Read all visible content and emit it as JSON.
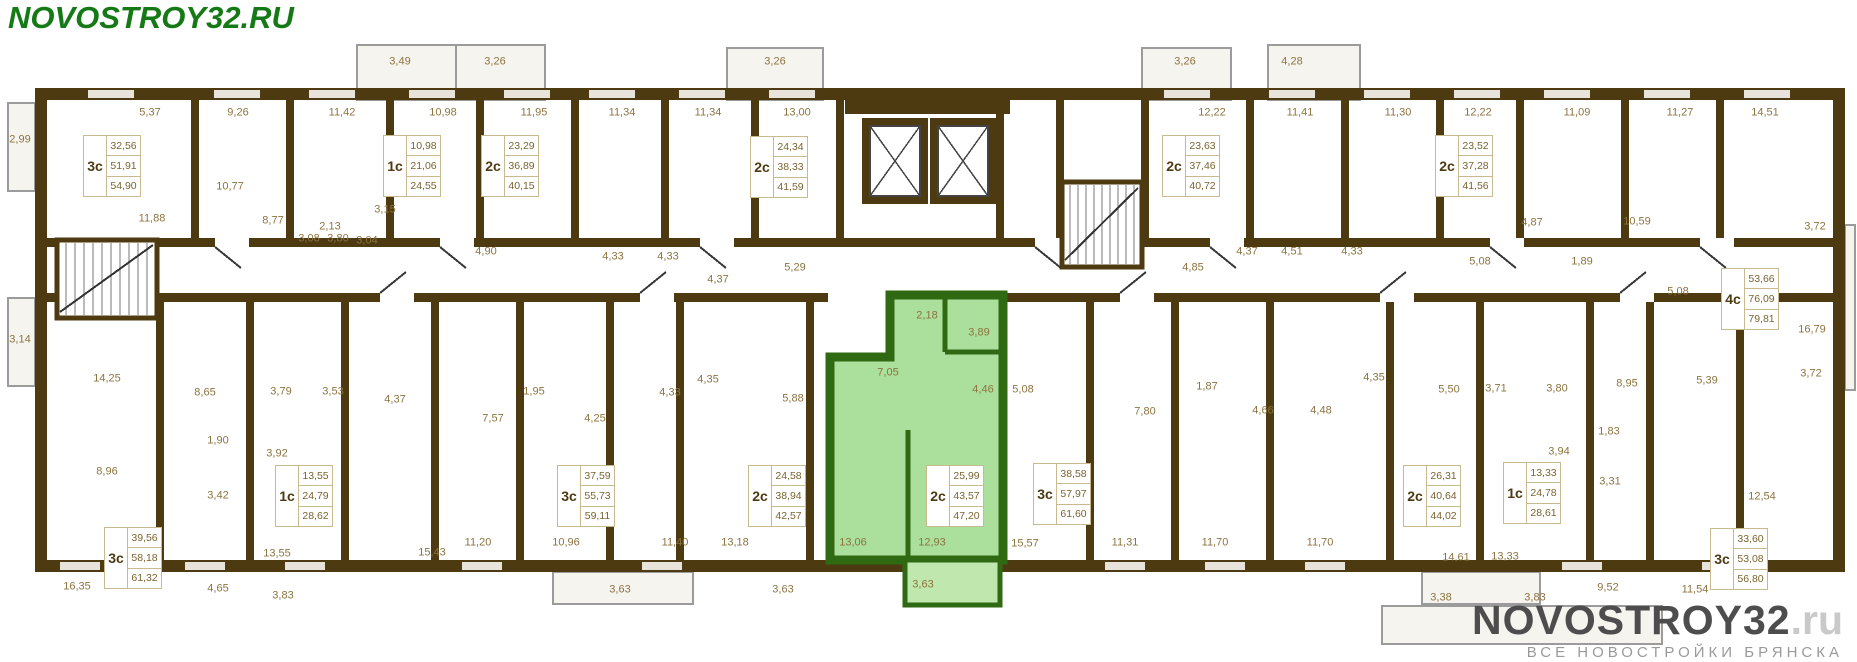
{
  "logo": {
    "text": "NOVOSTROY32.RU"
  },
  "watermark": {
    "brand": "NOVOSTROY32",
    "tld": ".ru",
    "tagline": "ВСЕ НОВОСТРОЙКИ БРЯНСКА"
  },
  "plan": {
    "colors": {
      "wall": "#4e3a11",
      "highlight_fill": "#abdf9c",
      "highlight_wall": "#2f6a12",
      "dimension_text": "#8c7440",
      "logo_green": "#157a15"
    },
    "apartments": [
      {
        "type": "3с",
        "areas": [
          "32,56",
          "51,91",
          "54,90"
        ],
        "x": 83,
        "y": 135,
        "highlighted": false
      },
      {
        "type": "1с",
        "areas": [
          "10,98",
          "21,06",
          "24,55"
        ],
        "x": 383,
        "y": 135,
        "highlighted": false
      },
      {
        "type": "2с",
        "areas": [
          "23,29",
          "36,89",
          "40,15"
        ],
        "x": 481,
        "y": 135,
        "highlighted": false
      },
      {
        "type": "2с",
        "areas": [
          "24,34",
          "38,33",
          "41,59"
        ],
        "x": 750,
        "y": 136,
        "highlighted": false
      },
      {
        "type": "2с",
        "areas": [
          "23,63",
          "37,46",
          "40,72"
        ],
        "x": 1162,
        "y": 135,
        "highlighted": false
      },
      {
        "type": "2с",
        "areas": [
          "23,52",
          "37,28",
          "41,56"
        ],
        "x": 1435,
        "y": 135,
        "highlighted": false
      },
      {
        "type": "4с",
        "areas": [
          "53,66",
          "76,09",
          "79,81"
        ],
        "x": 1721,
        "y": 268,
        "highlighted": false
      },
      {
        "type": "3с",
        "areas": [
          "39,56",
          "58,18",
          "61,32"
        ],
        "x": 104,
        "y": 527,
        "highlighted": false
      },
      {
        "type": "1с",
        "areas": [
          "13,55",
          "24,79",
          "28,62"
        ],
        "x": 275,
        "y": 465,
        "highlighted": false
      },
      {
        "type": "3с",
        "areas": [
          "37,59",
          "55,73",
          "59,11"
        ],
        "x": 557,
        "y": 465,
        "highlighted": false
      },
      {
        "type": "2с",
        "areas": [
          "24,58",
          "38,94",
          "42,57"
        ],
        "x": 748,
        "y": 465,
        "highlighted": false
      },
      {
        "type": "2с",
        "areas": [
          "25,99",
          "43,57",
          "47,20"
        ],
        "x": 926,
        "y": 465,
        "highlighted": true
      },
      {
        "type": "3с",
        "areas": [
          "38,58",
          "57,97",
          "61,60"
        ],
        "x": 1033,
        "y": 463,
        "highlighted": false
      },
      {
        "type": "2с",
        "areas": [
          "26,31",
          "40,64",
          "44,02"
        ],
        "x": 1403,
        "y": 465,
        "highlighted": false
      },
      {
        "type": "1с",
        "areas": [
          "13,33",
          "24,78",
          "28,61"
        ],
        "x": 1503,
        "y": 462,
        "highlighted": false
      },
      {
        "type": "3с",
        "areas": [
          "33,60",
          "53,08",
          "56,80"
        ],
        "x": 1710,
        "y": 528,
        "highlighted": false
      }
    ],
    "dimensions": [
      {
        "t": "5,37",
        "x": 150,
        "y": 113
      },
      {
        "t": "9,26",
        "x": 238,
        "y": 113
      },
      {
        "t": "11,42",
        "x": 342,
        "y": 113
      },
      {
        "t": "10,98",
        "x": 443,
        "y": 113
      },
      {
        "t": "11,95",
        "x": 534,
        "y": 113
      },
      {
        "t": "11,34",
        "x": 622,
        "y": 113
      },
      {
        "t": "11,34",
        "x": 708,
        "y": 113
      },
      {
        "t": "13,00",
        "x": 797,
        "y": 113
      },
      {
        "t": "12,22",
        "x": 1212,
        "y": 113
      },
      {
        "t": "11,41",
        "x": 1300,
        "y": 113
      },
      {
        "t": "11,30",
        "x": 1398,
        "y": 113
      },
      {
        "t": "12,22",
        "x": 1478,
        "y": 113
      },
      {
        "t": "11,09",
        "x": 1577,
        "y": 113
      },
      {
        "t": "11,27",
        "x": 1680,
        "y": 113
      },
      {
        "t": "14,51",
        "x": 1765,
        "y": 113
      },
      {
        "t": "3,49",
        "x": 400,
        "y": 62
      },
      {
        "t": "3,26",
        "x": 495,
        "y": 62
      },
      {
        "t": "3,26",
        "x": 775,
        "y": 62
      },
      {
        "t": "3,26",
        "x": 1185,
        "y": 62
      },
      {
        "t": "4,28",
        "x": 1292,
        "y": 62
      },
      {
        "t": "2,99",
        "x": 20,
        "y": 140
      },
      {
        "t": "3,14",
        "x": 20,
        "y": 340
      },
      {
        "t": "11,88",
        "x": 152,
        "y": 219
      },
      {
        "t": "10,77",
        "x": 230,
        "y": 187
      },
      {
        "t": "8,77",
        "x": 273,
        "y": 221
      },
      {
        "t": "2,13",
        "x": 330,
        "y": 227
      },
      {
        "t": "3,15",
        "x": 385,
        "y": 210
      },
      {
        "t": "3,08",
        "x": 309,
        "y": 239
      },
      {
        "t": "3,80",
        "x": 338,
        "y": 239
      },
      {
        "t": "3,04",
        "x": 367,
        "y": 241
      },
      {
        "t": "4,90",
        "x": 486,
        "y": 252
      },
      {
        "t": "4,33",
        "x": 613,
        "y": 257
      },
      {
        "t": "4,33",
        "x": 668,
        "y": 257
      },
      {
        "t": "4,37",
        "x": 718,
        "y": 280
      },
      {
        "t": "5,29",
        "x": 795,
        "y": 268
      },
      {
        "t": "4,85",
        "x": 1193,
        "y": 268
      },
      {
        "t": "4,37",
        "x": 1247,
        "y": 252
      },
      {
        "t": "4,51",
        "x": 1292,
        "y": 252
      },
      {
        "t": "4,33",
        "x": 1352,
        "y": 252
      },
      {
        "t": "5,08",
        "x": 1480,
        "y": 262
      },
      {
        "t": "4,87",
        "x": 1532,
        "y": 223
      },
      {
        "t": "1,89",
        "x": 1582,
        "y": 262
      },
      {
        "t": "10,59",
        "x": 1637,
        "y": 222
      },
      {
        "t": "3,72",
        "x": 1815,
        "y": 227
      },
      {
        "t": "5,08",
        "x": 1678,
        "y": 292
      },
      {
        "t": "16,79",
        "x": 1812,
        "y": 330
      },
      {
        "t": "3,72",
        "x": 1811,
        "y": 374
      },
      {
        "t": "2,18",
        "x": 927,
        "y": 316
      },
      {
        "t": "3,89",
        "x": 979,
        "y": 333
      },
      {
        "t": "7,05",
        "x": 888,
        "y": 373
      },
      {
        "t": "4,46",
        "x": 983,
        "y": 390
      },
      {
        "t": "5,08",
        "x": 1023,
        "y": 390
      },
      {
        "t": "4,35",
        "x": 708,
        "y": 380
      },
      {
        "t": "5,88",
        "x": 793,
        "y": 399
      },
      {
        "t": "14,25",
        "x": 107,
        "y": 379
      },
      {
        "t": "8,65",
        "x": 205,
        "y": 393
      },
      {
        "t": "3,79",
        "x": 281,
        "y": 392
      },
      {
        "t": "3,53",
        "x": 333,
        "y": 392
      },
      {
        "t": "1,90",
        "x": 218,
        "y": 441
      },
      {
        "t": "8,96",
        "x": 107,
        "y": 472
      },
      {
        "t": "3,42",
        "x": 218,
        "y": 496
      },
      {
        "t": "3,92",
        "x": 277,
        "y": 454
      },
      {
        "t": "16,35",
        "x": 77,
        "y": 587
      },
      {
        "t": "4,65",
        "x": 218,
        "y": 589
      },
      {
        "t": "13,55",
        "x": 277,
        "y": 554
      },
      {
        "t": "3,83",
        "x": 283,
        "y": 596
      },
      {
        "t": "4,37",
        "x": 395,
        "y": 400
      },
      {
        "t": "7,57",
        "x": 493,
        "y": 419
      },
      {
        "t": "1,95",
        "x": 534,
        "y": 392
      },
      {
        "t": "4,25",
        "x": 595,
        "y": 419
      },
      {
        "t": "4,33",
        "x": 670,
        "y": 393
      },
      {
        "t": "15,43",
        "x": 432,
        "y": 553
      },
      {
        "t": "11,20",
        "x": 478,
        "y": 543
      },
      {
        "t": "10,96",
        "x": 566,
        "y": 543
      },
      {
        "t": "11,40",
        "x": 675,
        "y": 543
      },
      {
        "t": "13,18",
        "x": 735,
        "y": 543
      },
      {
        "t": "3,63",
        "x": 620,
        "y": 590
      },
      {
        "t": "3,63",
        "x": 783,
        "y": 590
      },
      {
        "t": "13,06",
        "x": 853,
        "y": 543
      },
      {
        "t": "12,93",
        "x": 932,
        "y": 543
      },
      {
        "t": "3,63",
        "x": 923,
        "y": 585
      },
      {
        "t": "15,57",
        "x": 1025,
        "y": 544
      },
      {
        "t": "7,80",
        "x": 1145,
        "y": 412
      },
      {
        "t": "1,87",
        "x": 1207,
        "y": 387
      },
      {
        "t": "4,66",
        "x": 1263,
        "y": 411
      },
      {
        "t": "4,48",
        "x": 1321,
        "y": 411
      },
      {
        "t": "4,35",
        "x": 1374,
        "y": 378
      },
      {
        "t": "5,50",
        "x": 1449,
        "y": 390
      },
      {
        "t": "11,31",
        "x": 1125,
        "y": 543
      },
      {
        "t": "11,70",
        "x": 1215,
        "y": 543
      },
      {
        "t": "11,70",
        "x": 1320,
        "y": 543
      },
      {
        "t": "14,61",
        "x": 1456,
        "y": 558
      },
      {
        "t": "13,33",
        "x": 1505,
        "y": 557
      },
      {
        "t": "3,38",
        "x": 1441,
        "y": 598
      },
      {
        "t": "3,83",
        "x": 1535,
        "y": 598
      },
      {
        "t": "3,71",
        "x": 1496,
        "y": 389
      },
      {
        "t": "3,80",
        "x": 1557,
        "y": 389
      },
      {
        "t": "8,95",
        "x": 1627,
        "y": 384
      },
      {
        "t": "5,39",
        "x": 1707,
        "y": 381
      },
      {
        "t": "1,83",
        "x": 1609,
        "y": 432
      },
      {
        "t": "3,31",
        "x": 1610,
        "y": 482
      },
      {
        "t": "3,94",
        "x": 1559,
        "y": 452
      },
      {
        "t": "12,54",
        "x": 1762,
        "y": 497
      },
      {
        "t": "9,52",
        "x": 1608,
        "y": 588
      },
      {
        "t": "11,54",
        "x": 1695,
        "y": 590
      }
    ]
  }
}
